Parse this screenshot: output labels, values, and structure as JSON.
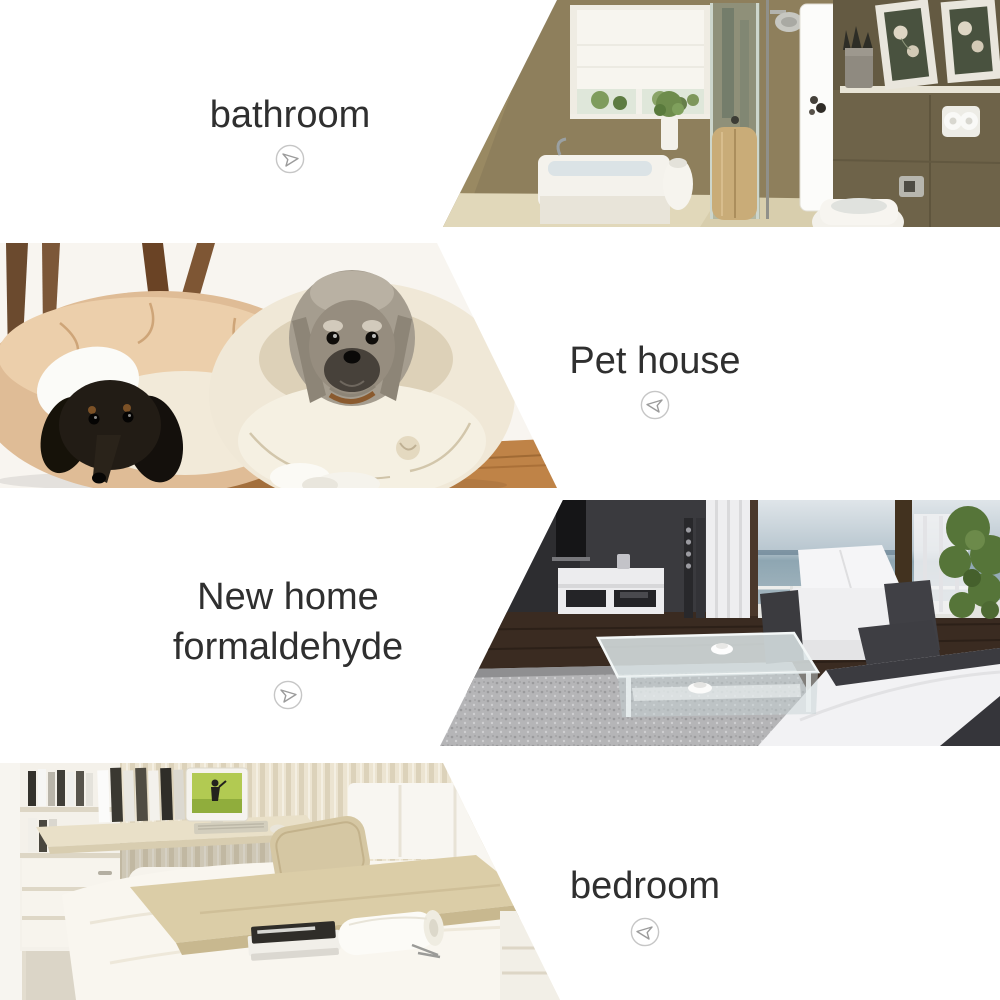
{
  "page": {
    "background_color": "#ffffff",
    "width": 1000,
    "height": 1000
  },
  "palette": {
    "label_text": "#2f2f2f",
    "arrow_circle": "#c6c6c6",
    "arrow_glyph": "#9b9b9b"
  },
  "sections": [
    {
      "name": "bathroom",
      "label": "bathroom",
      "arrow": "right",
      "arrow_icon": "arrow-right-icon",
      "photo_description": "bathroom with tan walls, window blind, bathtub, glass shower, white door, framed pictures, bidet"
    },
    {
      "name": "pet-house",
      "label": "Pet house",
      "arrow": "left",
      "arrow_icon": "arrow-left-icon",
      "photo_description": "two dogs resting in round donut pet beds, black dachshund in tan bed, grey schnauzer in cream bed, wooden floor"
    },
    {
      "name": "new-home-formaldehyde",
      "label_line1": "New home",
      "label_line2": "formaldehyde",
      "arrow": "right",
      "arrow_icon": "arrow-right-icon",
      "photo_description": "modern living room, dark wall with TV, white TV stand, glass coffee table, grey rug, white sofa with dark armrests, balcony windows, green plant"
    },
    {
      "name": "bedroom",
      "label": "bedroom",
      "arrow": "left",
      "arrow_icon": "arrow-left-icon",
      "photo_description": "white bedroom with shelf unit, desk with monitor, striped blind wall, white bed with beige pillow and blanket, magazines and towel on bed"
    }
  ]
}
